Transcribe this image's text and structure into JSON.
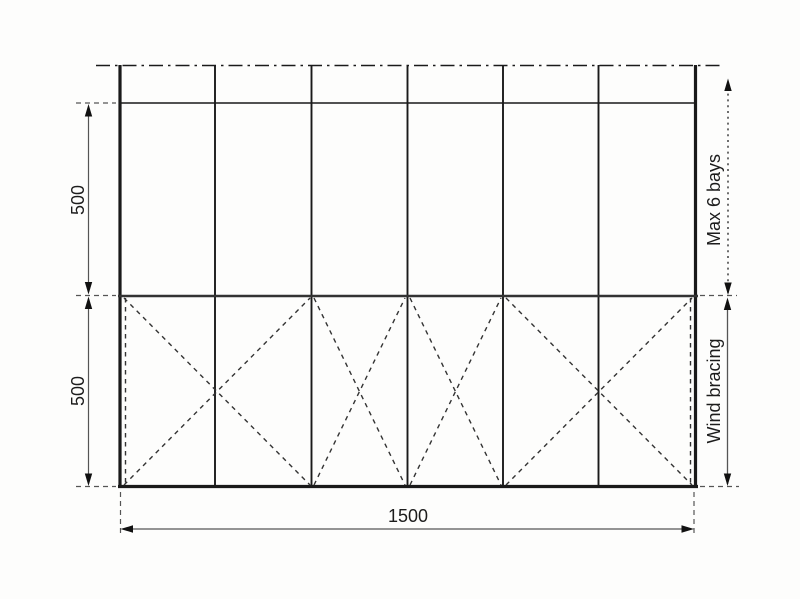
{
  "diagram": {
    "type": "structural-frame-elevation",
    "bay_count": 6,
    "labels": {
      "upper_height": "500",
      "lower_height": "500",
      "total_width": "1500",
      "max_bays": "Max 6 bays",
      "wind_bracing": "Wind bracing"
    },
    "colors": {
      "structure_line": "#1a1a1a",
      "rail_line": "#333333",
      "bracing_line": "#333333",
      "dimension_line": "#555555",
      "arrow_fill": "#111111",
      "text": "#1c1c1c",
      "background": "#fdfdfc"
    }
  }
}
